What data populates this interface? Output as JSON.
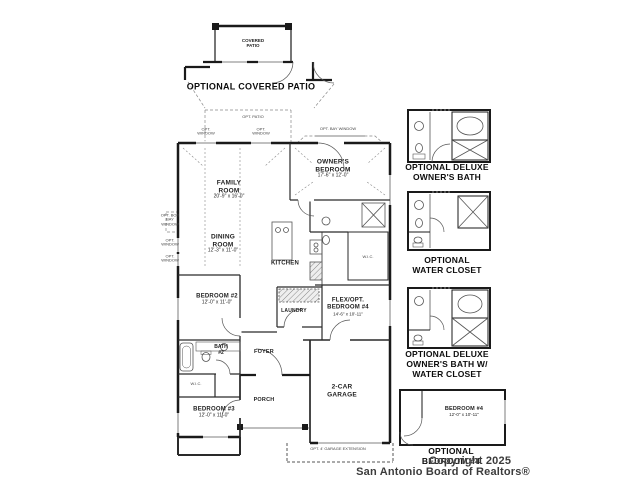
{
  "watermark": {
    "line1": "Copyright 2025",
    "line2": "San Antonio Board of Realtors®"
  },
  "optional_patio": {
    "room_label": "COVERED PATIO",
    "caption": "OPTIONAL COVERED PATIO"
  },
  "main_plan": {
    "rooms": {
      "family": {
        "name": "FAMILY ROOM",
        "dims": "20'-9\" x 16'-0\""
      },
      "owners_bedroom": {
        "name": "OWNER'S BEDROOM",
        "dims": "17'-6\" x 12'-0\""
      },
      "dining": {
        "name": "DINING ROOM",
        "dims": "12'-3\" x 11'-0\""
      },
      "kitchen": {
        "name": "KITCHEN"
      },
      "laundry": {
        "name": "LAUNDRY"
      },
      "bedroom2": {
        "name": "BEDROOM #2",
        "dims": "12'-0\" x 11'-0\""
      },
      "bath2": {
        "name": "BATH #2"
      },
      "bedroom3": {
        "name": "BEDROOM #3",
        "dims": "12'-0\" x 11'-0\""
      },
      "flex_bedroom4": {
        "name": "FLEX/OPT. BEDROOM #4",
        "dims": "14'-6\" x 10'-11\""
      },
      "garage": {
        "name": "2-CAR GARAGE"
      },
      "foyer": {
        "name": "FOYER"
      },
      "porch": {
        "name": "PORCH"
      },
      "wic": {
        "name": "W.I.C."
      }
    },
    "annotations": {
      "opt_patio": "OPT. PATIO",
      "opt_window": "OPT. WINDOW",
      "opt_bay_window": "OPT. BAY WINDOW",
      "opt_box_bay_window": "OPT. BOX BAY WINDOW",
      "opt_garage_extension": "OPT. 4' GARAGE EXTENSION"
    }
  },
  "optional_plans": {
    "deluxe_owners_bath": {
      "caption_lines": [
        "OPTIONAL DELUXE",
        "OWNER'S BATH"
      ]
    },
    "water_closet": {
      "caption_lines": [
        "OPTIONAL",
        "WATER CLOSET"
      ]
    },
    "deluxe_owners_bath_water_closet": {
      "caption_lines": [
        "OPTIONAL DELUXE",
        "OWNER'S BATH W/",
        "WATER CLOSET"
      ]
    },
    "bedroom4": {
      "room_name": "BEDROOM #4",
      "room_dims": "12'-0\" x 10'-11\"",
      "caption_lines": [
        "OPTIONAL",
        "BEDROOM #4"
      ]
    }
  }
}
